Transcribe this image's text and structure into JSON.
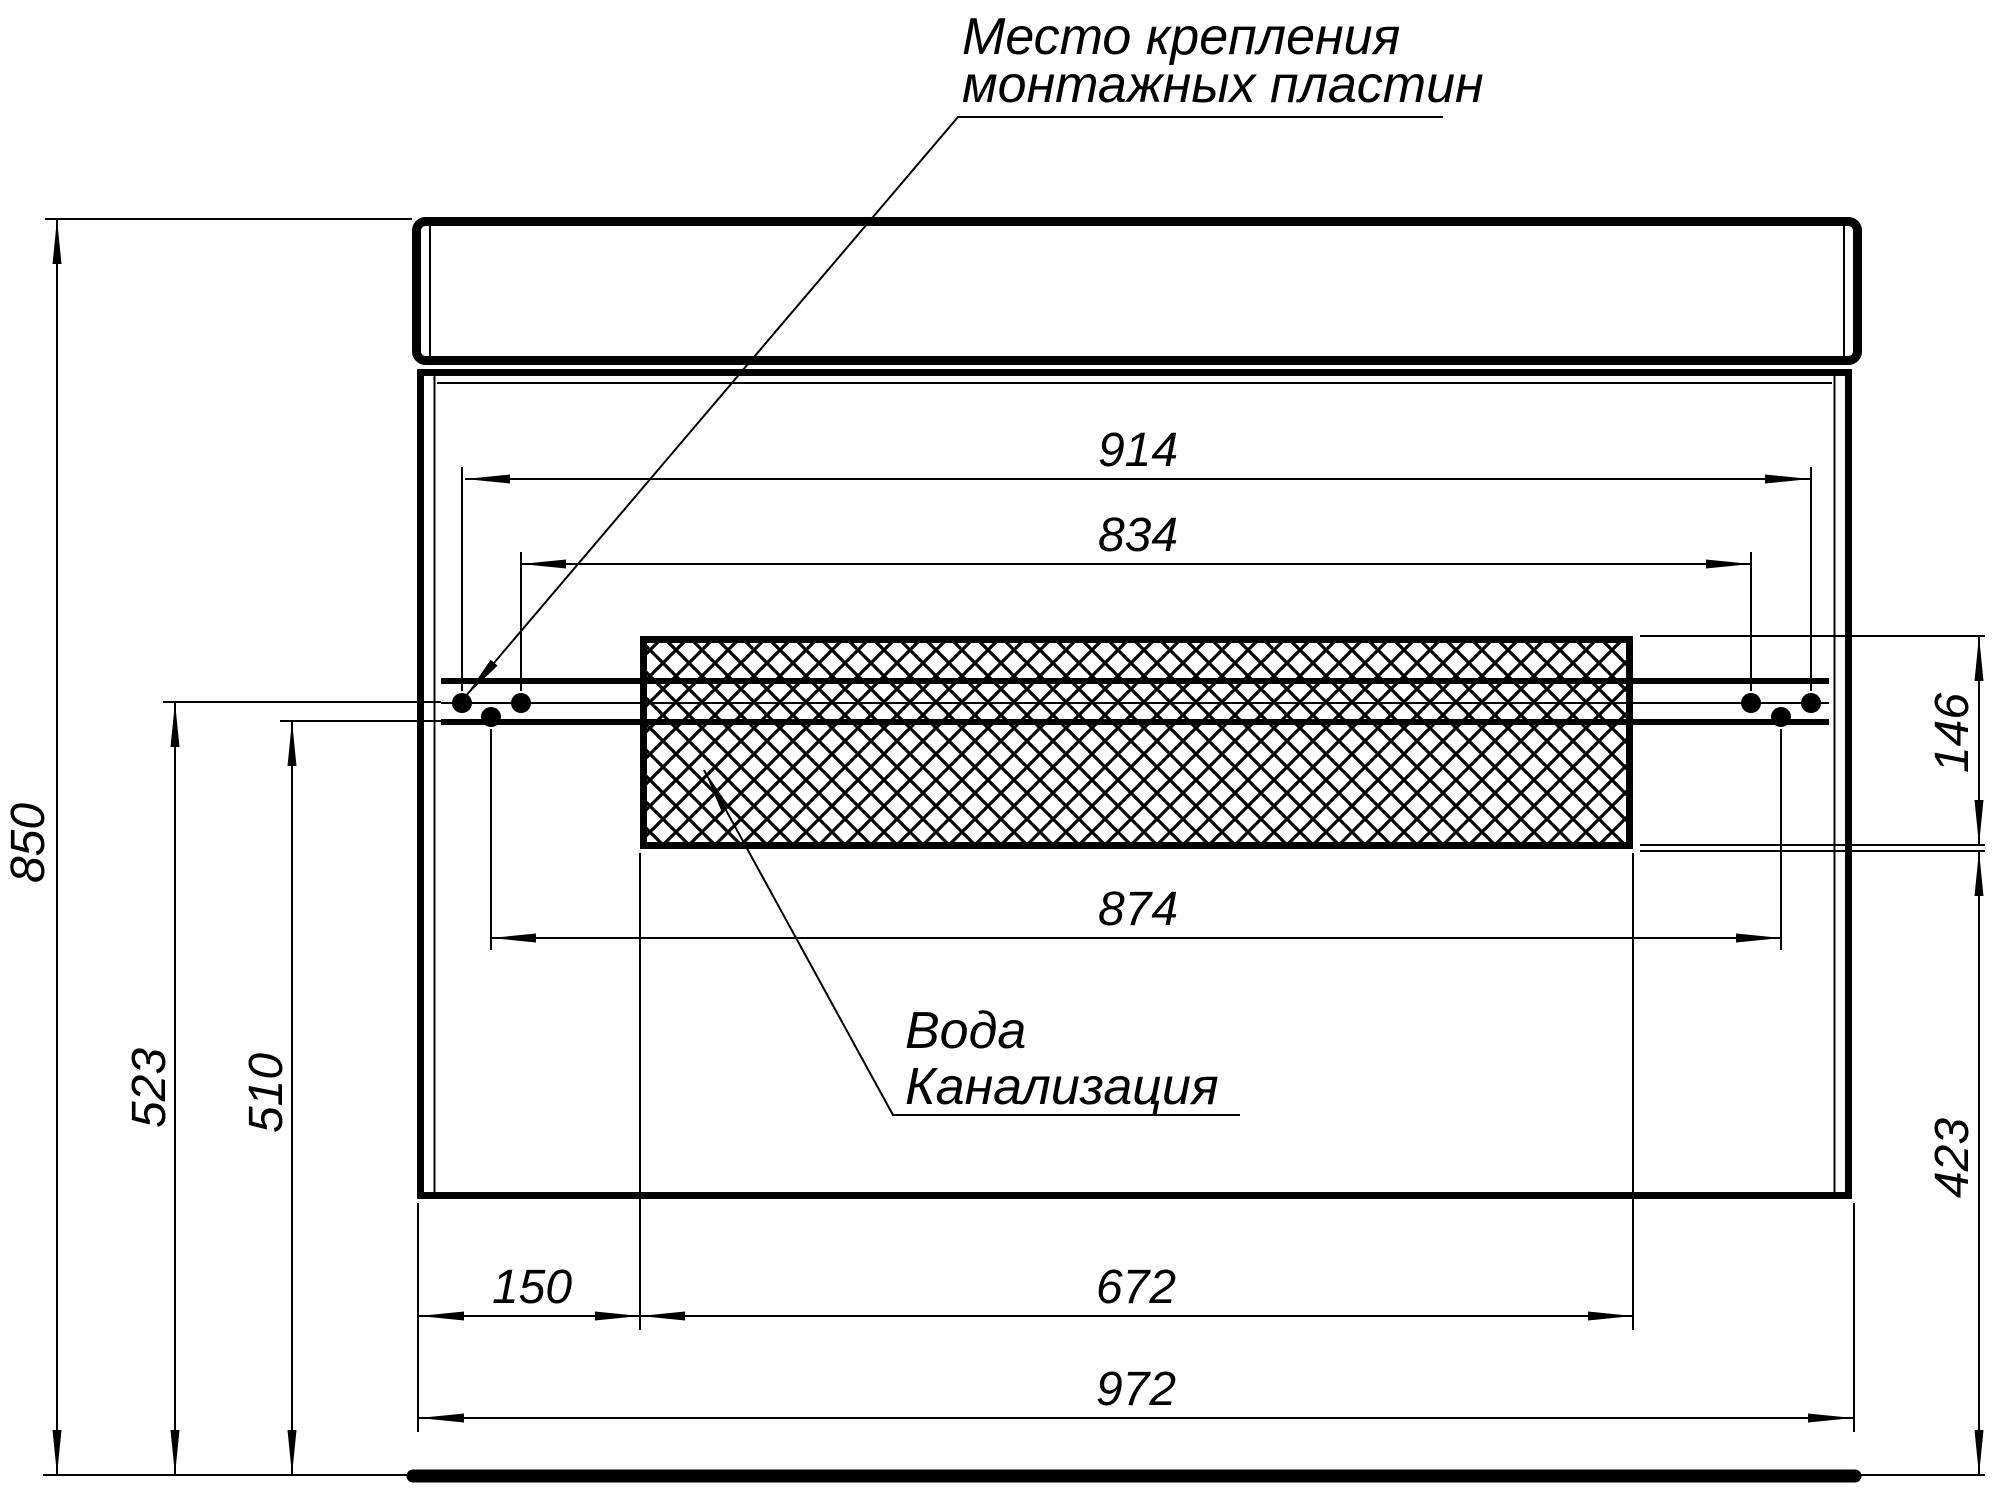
{
  "drawing": {
    "annotations": {
      "mounting_note": {
        "line1": "Место крепления",
        "line2": "монтажных пластин"
      },
      "utilities_note": {
        "line1": "Вода",
        "line2": "Канализация"
      }
    },
    "dimensions_mm": {
      "overall_height": "850",
      "overall_width": "972",
      "plates_outer_span": "914",
      "plates_inner_span": "834",
      "plates_lower_span": "874",
      "hatch_left_offset": "150",
      "hatch_width": "672",
      "hatch_height": "146",
      "hatch_bottom_to_floor": "423",
      "upper_plates_to_floor": "523",
      "lower_plates_to_floor": "510"
    },
    "colors": {
      "line": "#000000",
      "background": "#ffffff"
    }
  }
}
